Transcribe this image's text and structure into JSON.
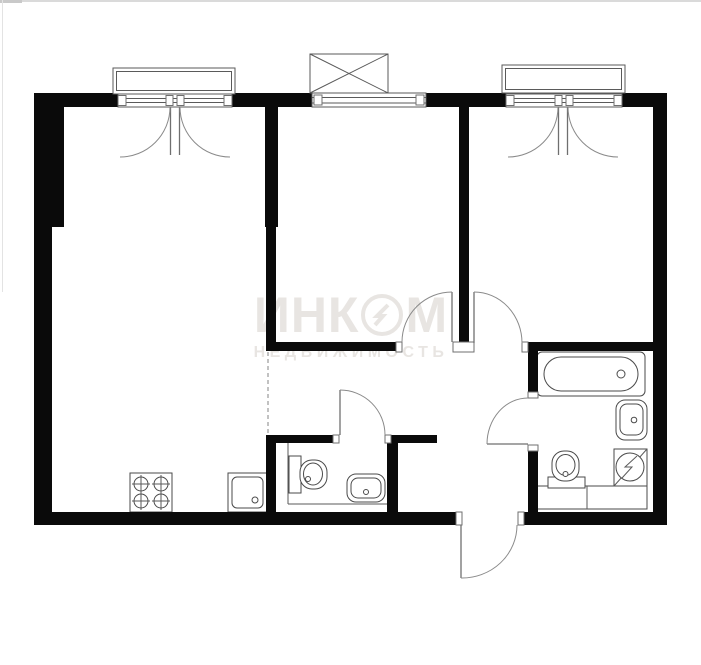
{
  "watermark": {
    "brand_left": "ИНК",
    "brand_right": "М",
    "brand_full": "ИНКОМ",
    "subtitle": "НЕДВИЖИМОСТЬ"
  },
  "colors": {
    "background": "#ffffff",
    "wall": "#0a0a0a",
    "thin_line": "#5a5a5a",
    "watermark": "#e8e5e2",
    "page_border": "#dadada"
  },
  "plan": {
    "type": "apartment-floor-plan",
    "rooms": [
      "living-room-with-kitchen-zone",
      "room-middle",
      "room-right",
      "bathroom",
      "wc",
      "hallway"
    ],
    "windows_count": 3,
    "doors_count": 5,
    "symbols": [
      "stove-icon",
      "kitchen-sink-icon",
      "wc-toilet-icon",
      "wc-sink-icon",
      "bathtub-icon",
      "bath-sink-icon",
      "bath-toilet-icon",
      "water-heater-icon",
      "balcony-crossed-box-icon",
      "kitchen-zone-dashed-line"
    ]
  }
}
